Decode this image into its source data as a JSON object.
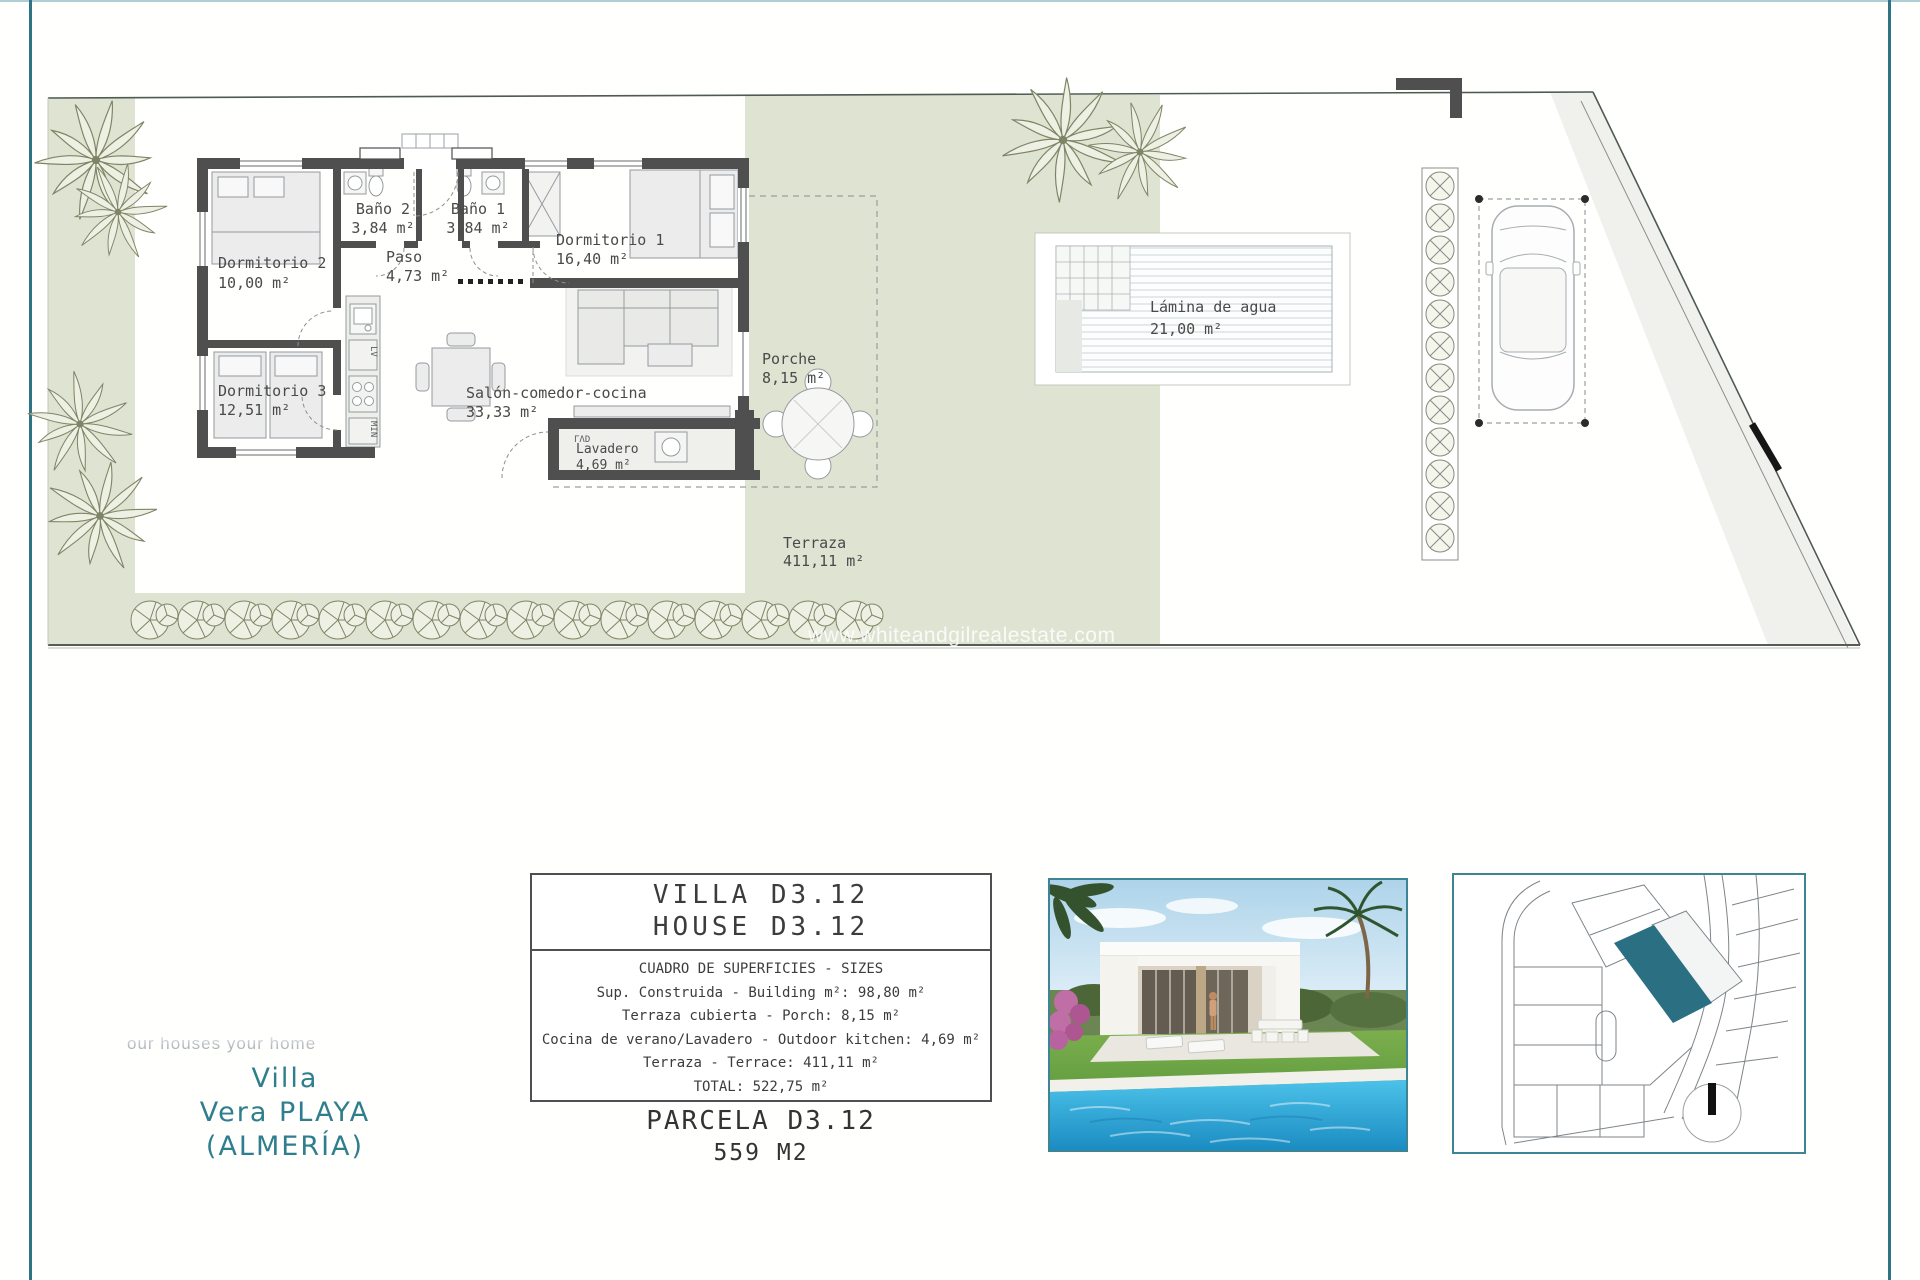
{
  "page": {
    "watermark": "www.whiteandgilrealestate.com"
  },
  "colors": {
    "accent_teal": "#2f7e8e",
    "box_border_teal": "#3d8494",
    "map_highlight": "#2b6f83",
    "garden_green": "#dfe3d2",
    "wall_gray": "#4f4f4f"
  },
  "plan": {
    "rooms": [
      {
        "name": "Dormitorio 2",
        "area": "10,00 m²"
      },
      {
        "name": "Baño 2",
        "area": "3,84 m²"
      },
      {
        "name": "Baño 1",
        "area": "3,84 m²"
      },
      {
        "name": "Dormitorio 1",
        "area": "16,40 m²"
      },
      {
        "name": "Paso",
        "area": "4,73 m²"
      },
      {
        "name": "Dormitorio 3",
        "area": "12,51 m²"
      },
      {
        "name": "Salón-comedor-cocina",
        "area": "33,33 m²"
      },
      {
        "name": "Porche",
        "area": "8,15 m²"
      },
      {
        "name": "Lavadero",
        "area": "4,69 m²"
      },
      {
        "name": "Terraza",
        "area": "411,11 m²"
      }
    ],
    "pool": {
      "name": "Lámina de agua",
      "area": "21,00 m²"
    },
    "appliance_mark": "ΓΛD",
    "kitchen_marks": [
      "LV",
      "MIN"
    ]
  },
  "branding": {
    "slogan": "our houses your home",
    "line1": "Villa",
    "line2": "Vera PLAYA",
    "line3": "(ALMERÍA)"
  },
  "info_box": {
    "title_line1": "VILLA D3.12",
    "title_line2": "HOUSE D3.12",
    "rows": [
      "CUADRO DE SUPERFICIES  - SIZES",
      "Sup. Construida  - Building m²: 98,80 m²",
      "Terraza cubierta  - Porch: 8,15 m²",
      "Cocina de verano/Lavadero  - Outdoor kitchen: 4,69 m²",
      "Terraza - Terrace: 411,11 m²",
      "TOTAL:  522,75 m²"
    ],
    "parcel": "PARCELA D3.12",
    "parcel_size": "559 M2"
  }
}
